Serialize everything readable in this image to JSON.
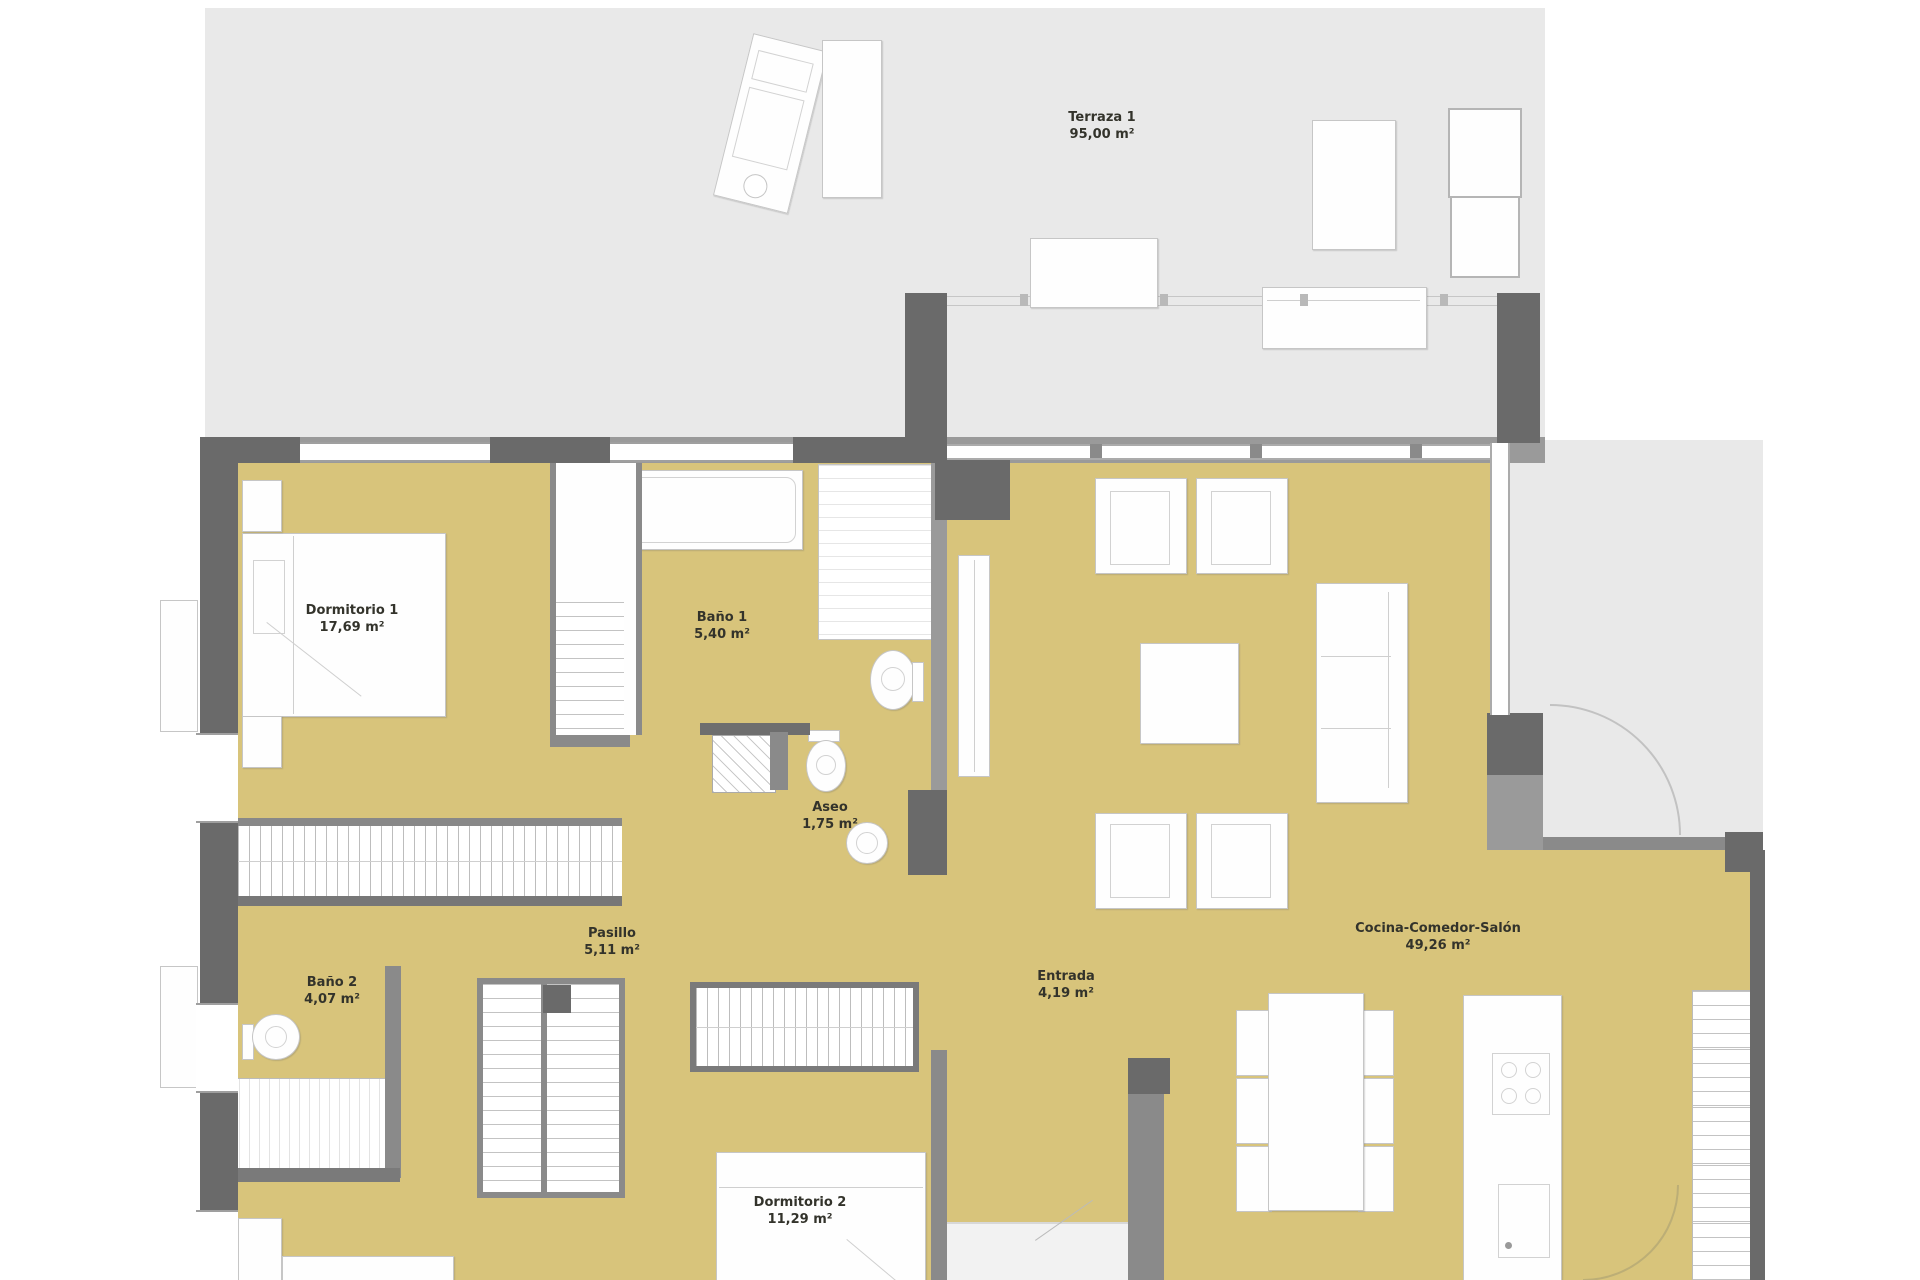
{
  "plan_type": "apartment floor plan",
  "rooms": [
    {
      "id": "terraza",
      "name": "Terraza 1",
      "area": "95,00 m²"
    },
    {
      "id": "dormitorio1",
      "name": "Dormitorio 1",
      "area": "17,69 m²"
    },
    {
      "id": "bano1",
      "name": "Baño 1",
      "area": "5,40 m²"
    },
    {
      "id": "aseo",
      "name": "Aseo",
      "area": "1,75 m²"
    },
    {
      "id": "pasillo",
      "name": "Pasillo",
      "area": "5,11 m²"
    },
    {
      "id": "bano2",
      "name": "Baño 2",
      "area": "4,07 m²"
    },
    {
      "id": "entrada",
      "name": "Entrada",
      "area": "4,19 m²"
    },
    {
      "id": "salon",
      "name": "Cocina-Comedor-Salón",
      "area": "49,26 m²"
    },
    {
      "id": "dormitorio2",
      "name": "Dormitorio 2",
      "area": "11,29 m²"
    }
  ],
  "colors": {
    "floor": "#d8c47b",
    "terrace": "#e9e9e9",
    "wall_dark": "#6a6a6a",
    "wall_light": "#9a9a9a",
    "furniture_outline": "#c6c6c6",
    "label_text": "#33332b",
    "background": "#ffffff"
  }
}
